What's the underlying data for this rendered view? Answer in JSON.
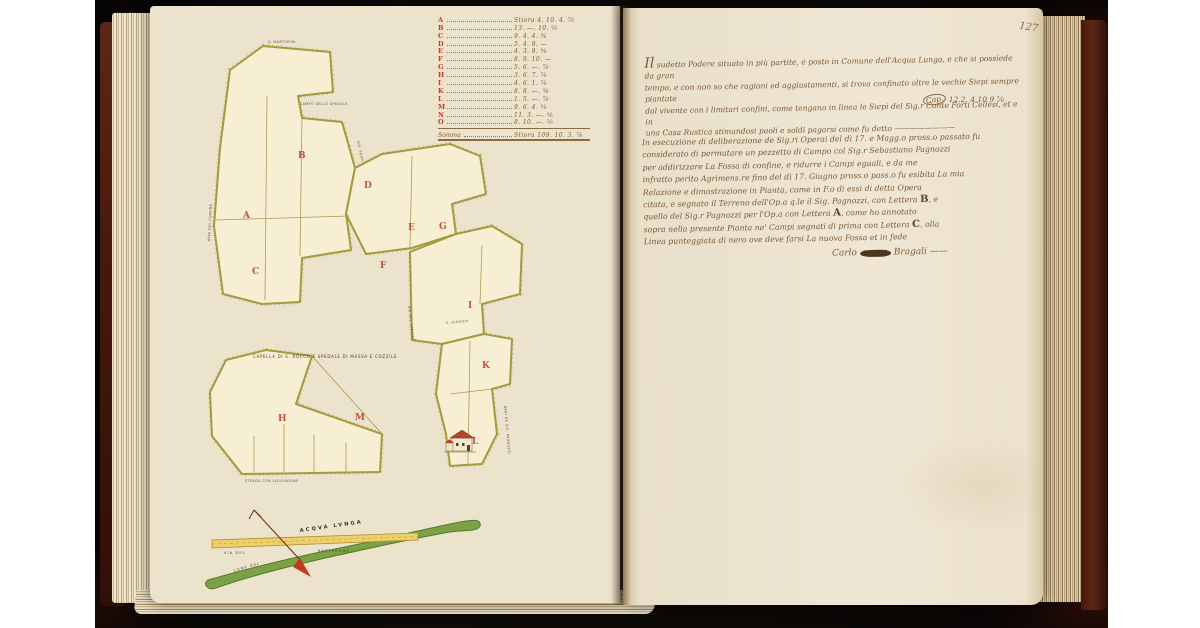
{
  "folio_number": "127",
  "left_page": {
    "measure_table": {
      "rows": [
        {
          "letter": "A",
          "value": "Stiora 4. 10. 4. ⅞"
        },
        {
          "letter": "B",
          "value": "13. —. 10. ⅝"
        },
        {
          "letter": "C",
          "value": "9. 4. 4. ¾"
        },
        {
          "letter": "D",
          "value": "5. 4. 9. —"
        },
        {
          "letter": "E",
          "value": "4. 3. 9. ⅚"
        },
        {
          "letter": "F",
          "value": "8. 9. 10. —"
        },
        {
          "letter": "G",
          "value": "5. 6. —. ⅞"
        },
        {
          "letter": "H",
          "value": "3. 6. 7. ⅞"
        },
        {
          "letter": "I",
          "value": "4. 6. 1. ⅞"
        },
        {
          "letter": "K",
          "value": "8. 8. —. ⅚"
        },
        {
          "letter": "L",
          "value": "1. 5. —. ⅞"
        },
        {
          "letter": "M",
          "value": "9. 6. 4. ⅛"
        },
        {
          "letter": "N",
          "value": "11. 3. —. ⅚"
        },
        {
          "letter": "O",
          "value": "8. 10. —. ⅛"
        }
      ],
      "summary_label": "Somma",
      "summary_value": "Stiora 109. 10. 3. ⅞"
    },
    "map": {
      "parcel_letters": [
        "A",
        "B",
        "C",
        "D",
        "E",
        "F",
        "G",
        "H",
        "I",
        "K",
        "L",
        "M"
      ],
      "chapel_label": "CAPELLA DI S. ROCCO E SPEDALE DI MASSA E COZZILE",
      "boundary_labels": [
        "S. MARTORINI",
        "CAMPO DELLO SPEDALE",
        "BENI DEL COMVNE",
        "SIG. FORTI",
        "S. GIORGIO",
        "VIA DEL CONFINE",
        "STRADA CON LEGGIADONE",
        "BENI DE SIG. PAGNOZZI"
      ],
      "river_label": "ACQVA LVNGA",
      "road_label_left": "VIA DEL",
      "road_label_right": "BOTTEGONE",
      "bank_label": "COME DEL"
    }
  },
  "right_page": {
    "paragraph1": {
      "line0_init": "Il",
      "line0_rest": " sudetto Podere situato in più partite, e posto in Comune dell'Acqua Lunga, e che si possiede da gran",
      "lines": [
        "tempo, e con non so che ragioni ed aggiustamenti, si trova confinato oltre le vechie Siepi sempre piantate",
        "dal vivente con i limitari confini, come tengano in linea le Siepi del Sig.r Conte Forti Cellesi, et e in",
        "una Casa Rustica stimandosi paoli e soldi pagarsi come fu detto ————————"
      ],
      "tail_mark": "Cap.",
      "tail_value": "12.2. 4 10 9 ⅞"
    },
    "paragraph2": {
      "lines": [
        {
          "t": "In esecuzione di deliberazione de Sig.ri Operai del dì 17. e Magg.o pross.o passato fu"
        },
        {
          "t": "considerato di permutare un pezzetto di Campo col Sig.r Sebastiano Pagnozzi"
        },
        {
          "t": "per addirizzare La Fossa di confine, e ridurre i Campi eguali, e da me"
        },
        {
          "t": "infratto perito Agrimens.re fino del dì 17. Giugno pross.o pass.o fu esibita La mia"
        },
        {
          "t": "Relazione e dimostrazione in Pianta, come in F.o di essi di detta Opera"
        },
        {
          "pre": "citata, e segnato il Terreno dell'Op.a q.le il Sig. Pagnozzi, con Lettera ",
          "b": "B",
          "post": ", e"
        },
        {
          "pre": "quello del Sig.r Pagnozzi per l'Op.a con Lettera ",
          "b": "A",
          "post": ", come ho annotato"
        },
        {
          "pre": "sopra nella presente Pianta ne' Campi segnati di prima con Lettera ",
          "b": "C",
          "post": ", olla"
        },
        {
          "t": "Linea punteggiata di nero ove deve farsi La nuova Fossa et in fede"
        }
      ],
      "signature_pre": "Carlo ",
      "signature_blot": "mano",
      "signature_post": " Bragali ——"
    }
  }
}
